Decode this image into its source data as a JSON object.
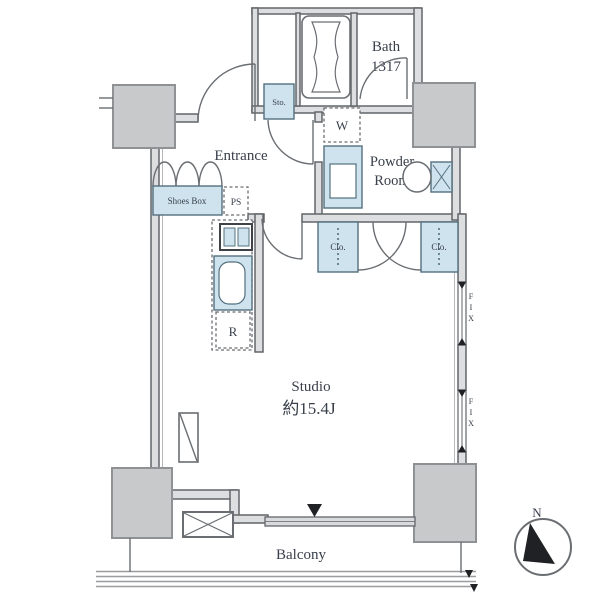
{
  "labels": {
    "entrance": "Entrance",
    "bath_name": "Bath",
    "bath_size": "1317",
    "powder_room_1": "Powder",
    "powder_room_2": "Room",
    "studio_name": "Studio",
    "studio_size": "約15.4J",
    "balcony": "Balcony",
    "storage": "Sto.",
    "washer": "W",
    "shoes_box": "Shoes Box",
    "pipe_shaft": "PS",
    "closet_left": "Clo.",
    "closet_right": "Clo.",
    "refrigerator": "R",
    "fix_window_upper": "FIX",
    "fix_window_lower": "FIX",
    "compass_north": "N"
  },
  "colors": {
    "fixture_blue": "#cfe3ee",
    "column_gray": "#c7c9ca",
    "wall_fill": "#dcdedf",
    "wall_stroke": "#62666a",
    "text": "#39404b",
    "marker_black": "#1f2125"
  }
}
